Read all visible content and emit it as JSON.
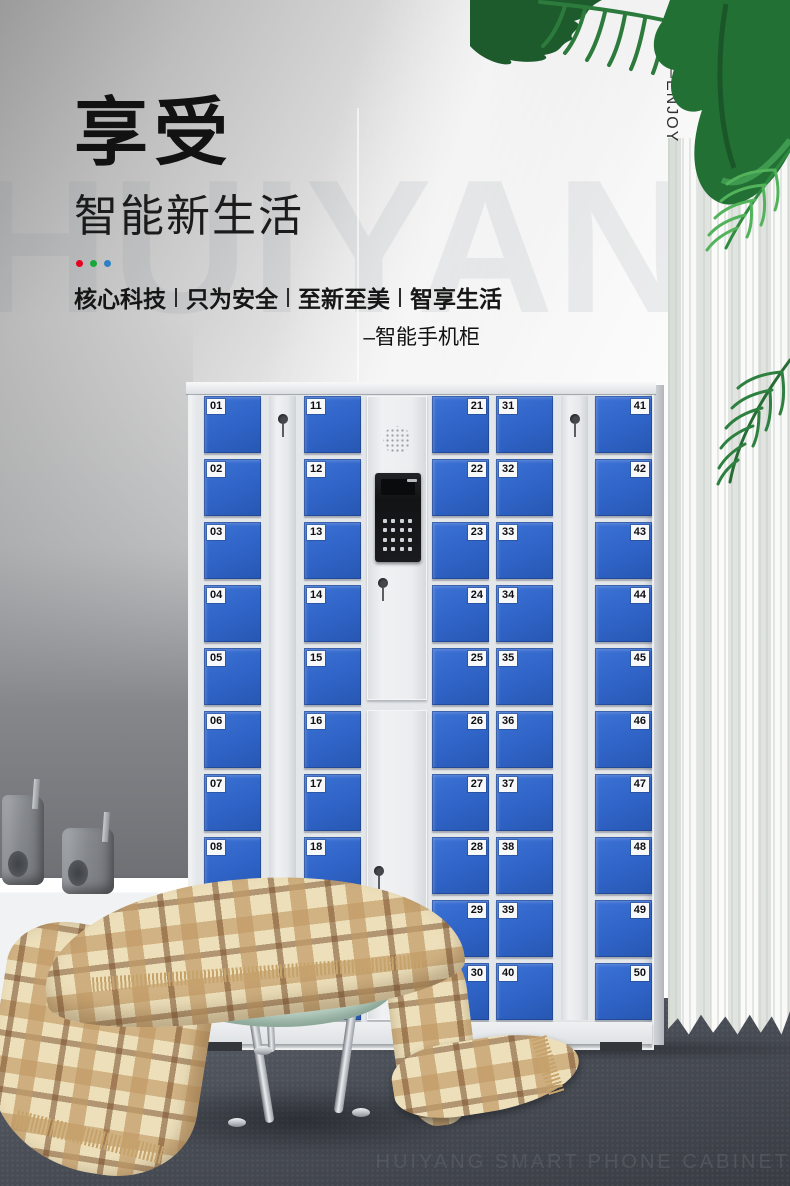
{
  "hero": {
    "title": "享受",
    "subtitle": "智能新生活",
    "tagline_segments": [
      "核心科技",
      "只为安全",
      "至新至美",
      "智享生活"
    ],
    "tagline_separator": "|",
    "product_label": "–智能手机柜",
    "accent_dot_colors": [
      "#e6001f",
      "#17a83b",
      "#2e80c4"
    ]
  },
  "side_text": {
    "enjoy_vertical": "—ENJOY"
  },
  "watermark": {
    "background_text": "HUIYANG",
    "bottom_caption": "HUIYANG SMART PHONE CABINET"
  },
  "cabinet": {
    "door_color": "#2f63c6",
    "frame_color": "#e4e7ea",
    "columns": [
      {
        "id": "column-1",
        "label_side": "left",
        "numbers": [
          "01",
          "02",
          "03",
          "04",
          "05",
          "06",
          "07",
          "08",
          "09",
          "10"
        ]
      },
      {
        "id": "column-2",
        "label_side": "left",
        "numbers": [
          "11",
          "12",
          "13",
          "14",
          "15",
          "16",
          "17",
          "18",
          "19",
          "20"
        ]
      },
      {
        "id": "column-3",
        "label_side": "right",
        "numbers": [
          "21",
          "22",
          "23",
          "24",
          "25",
          "26",
          "27",
          "28",
          "29",
          "30"
        ]
      },
      {
        "id": "column-4",
        "label_side": "left",
        "numbers": [
          "31",
          "32",
          "33",
          "34",
          "35",
          "36",
          "37",
          "38",
          "39",
          "40"
        ]
      },
      {
        "id": "column-5",
        "label_side": "right",
        "numbers": [
          "41",
          "42",
          "43",
          "44",
          "45",
          "46",
          "47",
          "48",
          "49",
          "50"
        ]
      }
    ]
  }
}
